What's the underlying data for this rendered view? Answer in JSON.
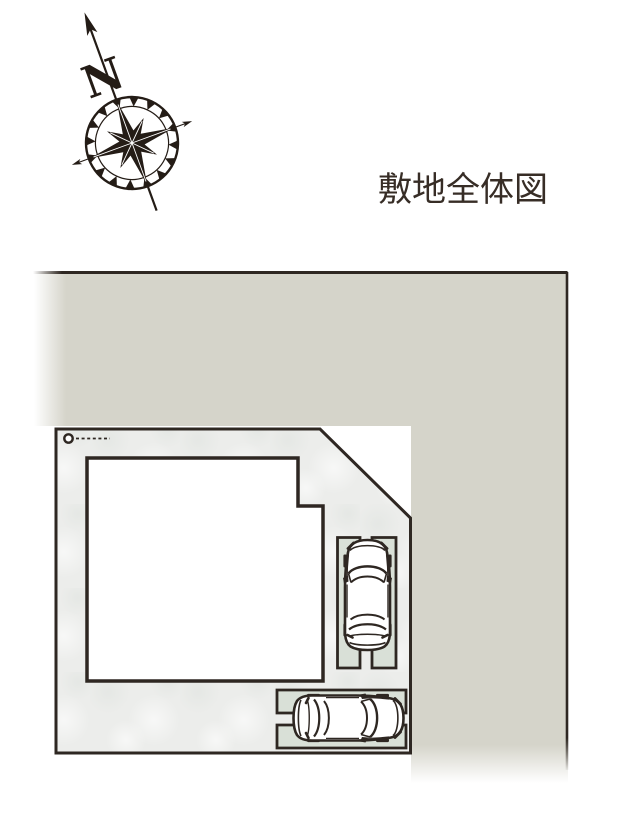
{
  "page": {
    "background_color": "#ffffff"
  },
  "header": {
    "title": "敷地全体図",
    "title_color": "#372d26"
  },
  "compass": {
    "north_label": "N",
    "color": "#241c16"
  },
  "plan": {
    "road_color": "#d5d4ca",
    "site_surface_color": "#ecedeb",
    "parking_stall_color": "#d9e0d7",
    "line_color": "#2e2722",
    "building_fill": "#ffffff",
    "car_count": 2,
    "car_color": "#ffffff",
    "car_outline_color": "#2e2722"
  }
}
